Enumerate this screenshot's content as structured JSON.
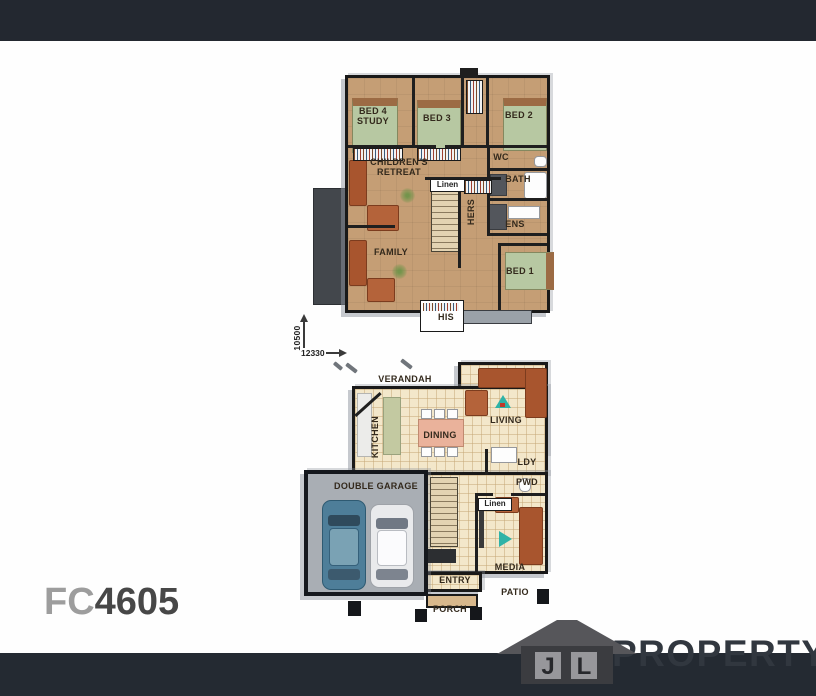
{
  "plan_code": {
    "prefix": "FC",
    "number": "4605"
  },
  "logo": {
    "letter_j": "J",
    "letter_l": "L",
    "brand": "PROPERTY"
  },
  "dims": {
    "height": "10500",
    "width": "12330"
  },
  "upper": {
    "bed4_l1": "BED 4",
    "bed4_l2": "STUDY",
    "bed3": "BED 3",
    "bed2": "BED 2",
    "wc": "WC",
    "bath": "BATH",
    "retreat_l1": "CHILDREN'S",
    "retreat_l2": "RETREAT",
    "linen": "Linen",
    "hers": "HERS",
    "ens": "ENS",
    "family": "FAMILY",
    "bed1": "BED 1",
    "his": "HIS"
  },
  "ground": {
    "verandah": "VERANDAH",
    "kitchen": "KITCHEN",
    "dining": "DINING",
    "living": "LIVING",
    "ldy": "LDY",
    "pwd": "PWD",
    "linen": "Linen",
    "media": "MEDIA",
    "garage": "DOUBLE GARAGE",
    "entry": "ENTRY",
    "patio": "PATIO",
    "porch": "PORCH"
  },
  "palette": {
    "top_bar": "#232830",
    "bottom_bar": "#242a32",
    "upper_floor": "#c59e75",
    "ground_floor": "#f3e7ca",
    "bed_green": "#b7c8a2",
    "sofa_orange": "#a8552e",
    "garage_gray": "#a9aeb4",
    "car_blue": "#4e7e99",
    "car_white": "#e9eaec",
    "icon_teal": "#2fb3a7"
  }
}
